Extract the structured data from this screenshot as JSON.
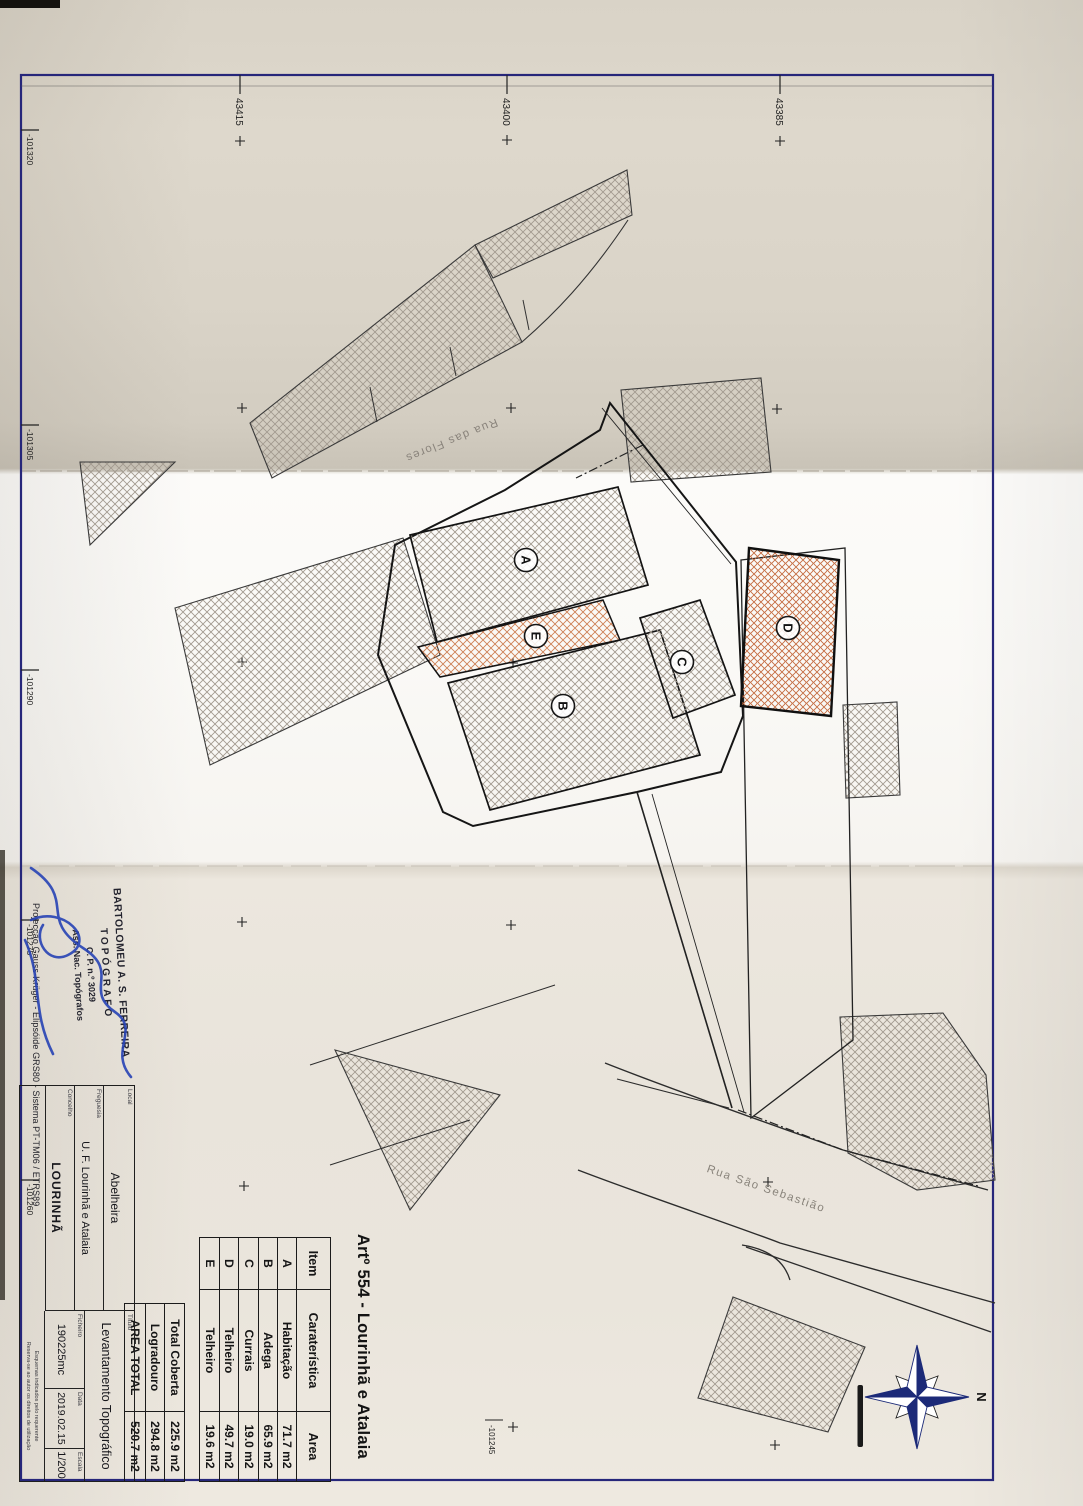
{
  "document": {
    "article_title": "Artº 554 - Lourinhã e Atalaia",
    "streets": {
      "flores": "Rua das Flores",
      "sebastiao": "Rua São Sebastião"
    },
    "compass": {
      "north_label": "N"
    },
    "building_labels": {
      "a": "A",
      "b": "B",
      "c": "C",
      "d": "D",
      "e": "E"
    },
    "colors": {
      "frame_navy": "#26267a",
      "hatch_gray": "#a29a8f",
      "hatch_orange": "#c46b40",
      "signature_blue": "#2743b5"
    }
  },
  "grid": {
    "left_labels": [
      "43415",
      "43400",
      "43385"
    ],
    "bottom_labels": [
      "-101320",
      "-101305",
      "-101290",
      "-101275",
      "-101260"
    ],
    "mid_label": "-101245"
  },
  "area_table": {
    "headers": {
      "item": "Item",
      "caracteristica": "Caraterística",
      "area": "Area"
    },
    "rows": [
      {
        "item": "A",
        "caracteristica": "Habitação",
        "area": "71.7 m2"
      },
      {
        "item": "B",
        "caracteristica": "Adega",
        "area": "65.9 m2"
      },
      {
        "item": "C",
        "caracteristica": "Currais",
        "area": "19.0 m2"
      },
      {
        "item": "D",
        "caracteristica": "Telheiro",
        "area": "49.7 m2"
      },
      {
        "item": "E",
        "caracteristica": "Telheiro",
        "area": "19.6 m2"
      }
    ],
    "summary": [
      {
        "label": "Total Coberta",
        "value": "225.9 m2"
      },
      {
        "label": "Logradouro",
        "value": "294.8 m2"
      },
      {
        "label": "AREA TOTAL",
        "value": "520.7 m2"
      }
    ]
  },
  "title_block": {
    "local_label": "Local",
    "local": "Abelheira",
    "freguesia_label": "Freguesia",
    "freguesia": "U. F. Lourinhã e Atalaia",
    "concelho_label": "Concelho",
    "concelho": "LOURINHÃ",
    "titulo_label": "Título",
    "titulo": "Levantamento Topográfico",
    "ficheiro_label": "Ficheiro",
    "ficheiro": "190225mc",
    "data_label": "Data",
    "data": "2019.02.15",
    "escala_label": "Escala",
    "escala": "1/200",
    "projection": "Projecção Gauss-Krüger - Elipsóide GRS80 - Sistema PT-TM06 / ETRS89",
    "note_line1": "Esquemas indicados pelo requerente",
    "note_line2": "Reserva-se ao autor os direitos de utilização"
  },
  "stamp": {
    "line1": "BARTOLOMEU A. S. FERREIRA",
    "line2": "TOPÓGRAFO",
    "line3": "C. P. n.º 3029",
    "line4": "Ass. Nac. Topógrafos"
  }
}
